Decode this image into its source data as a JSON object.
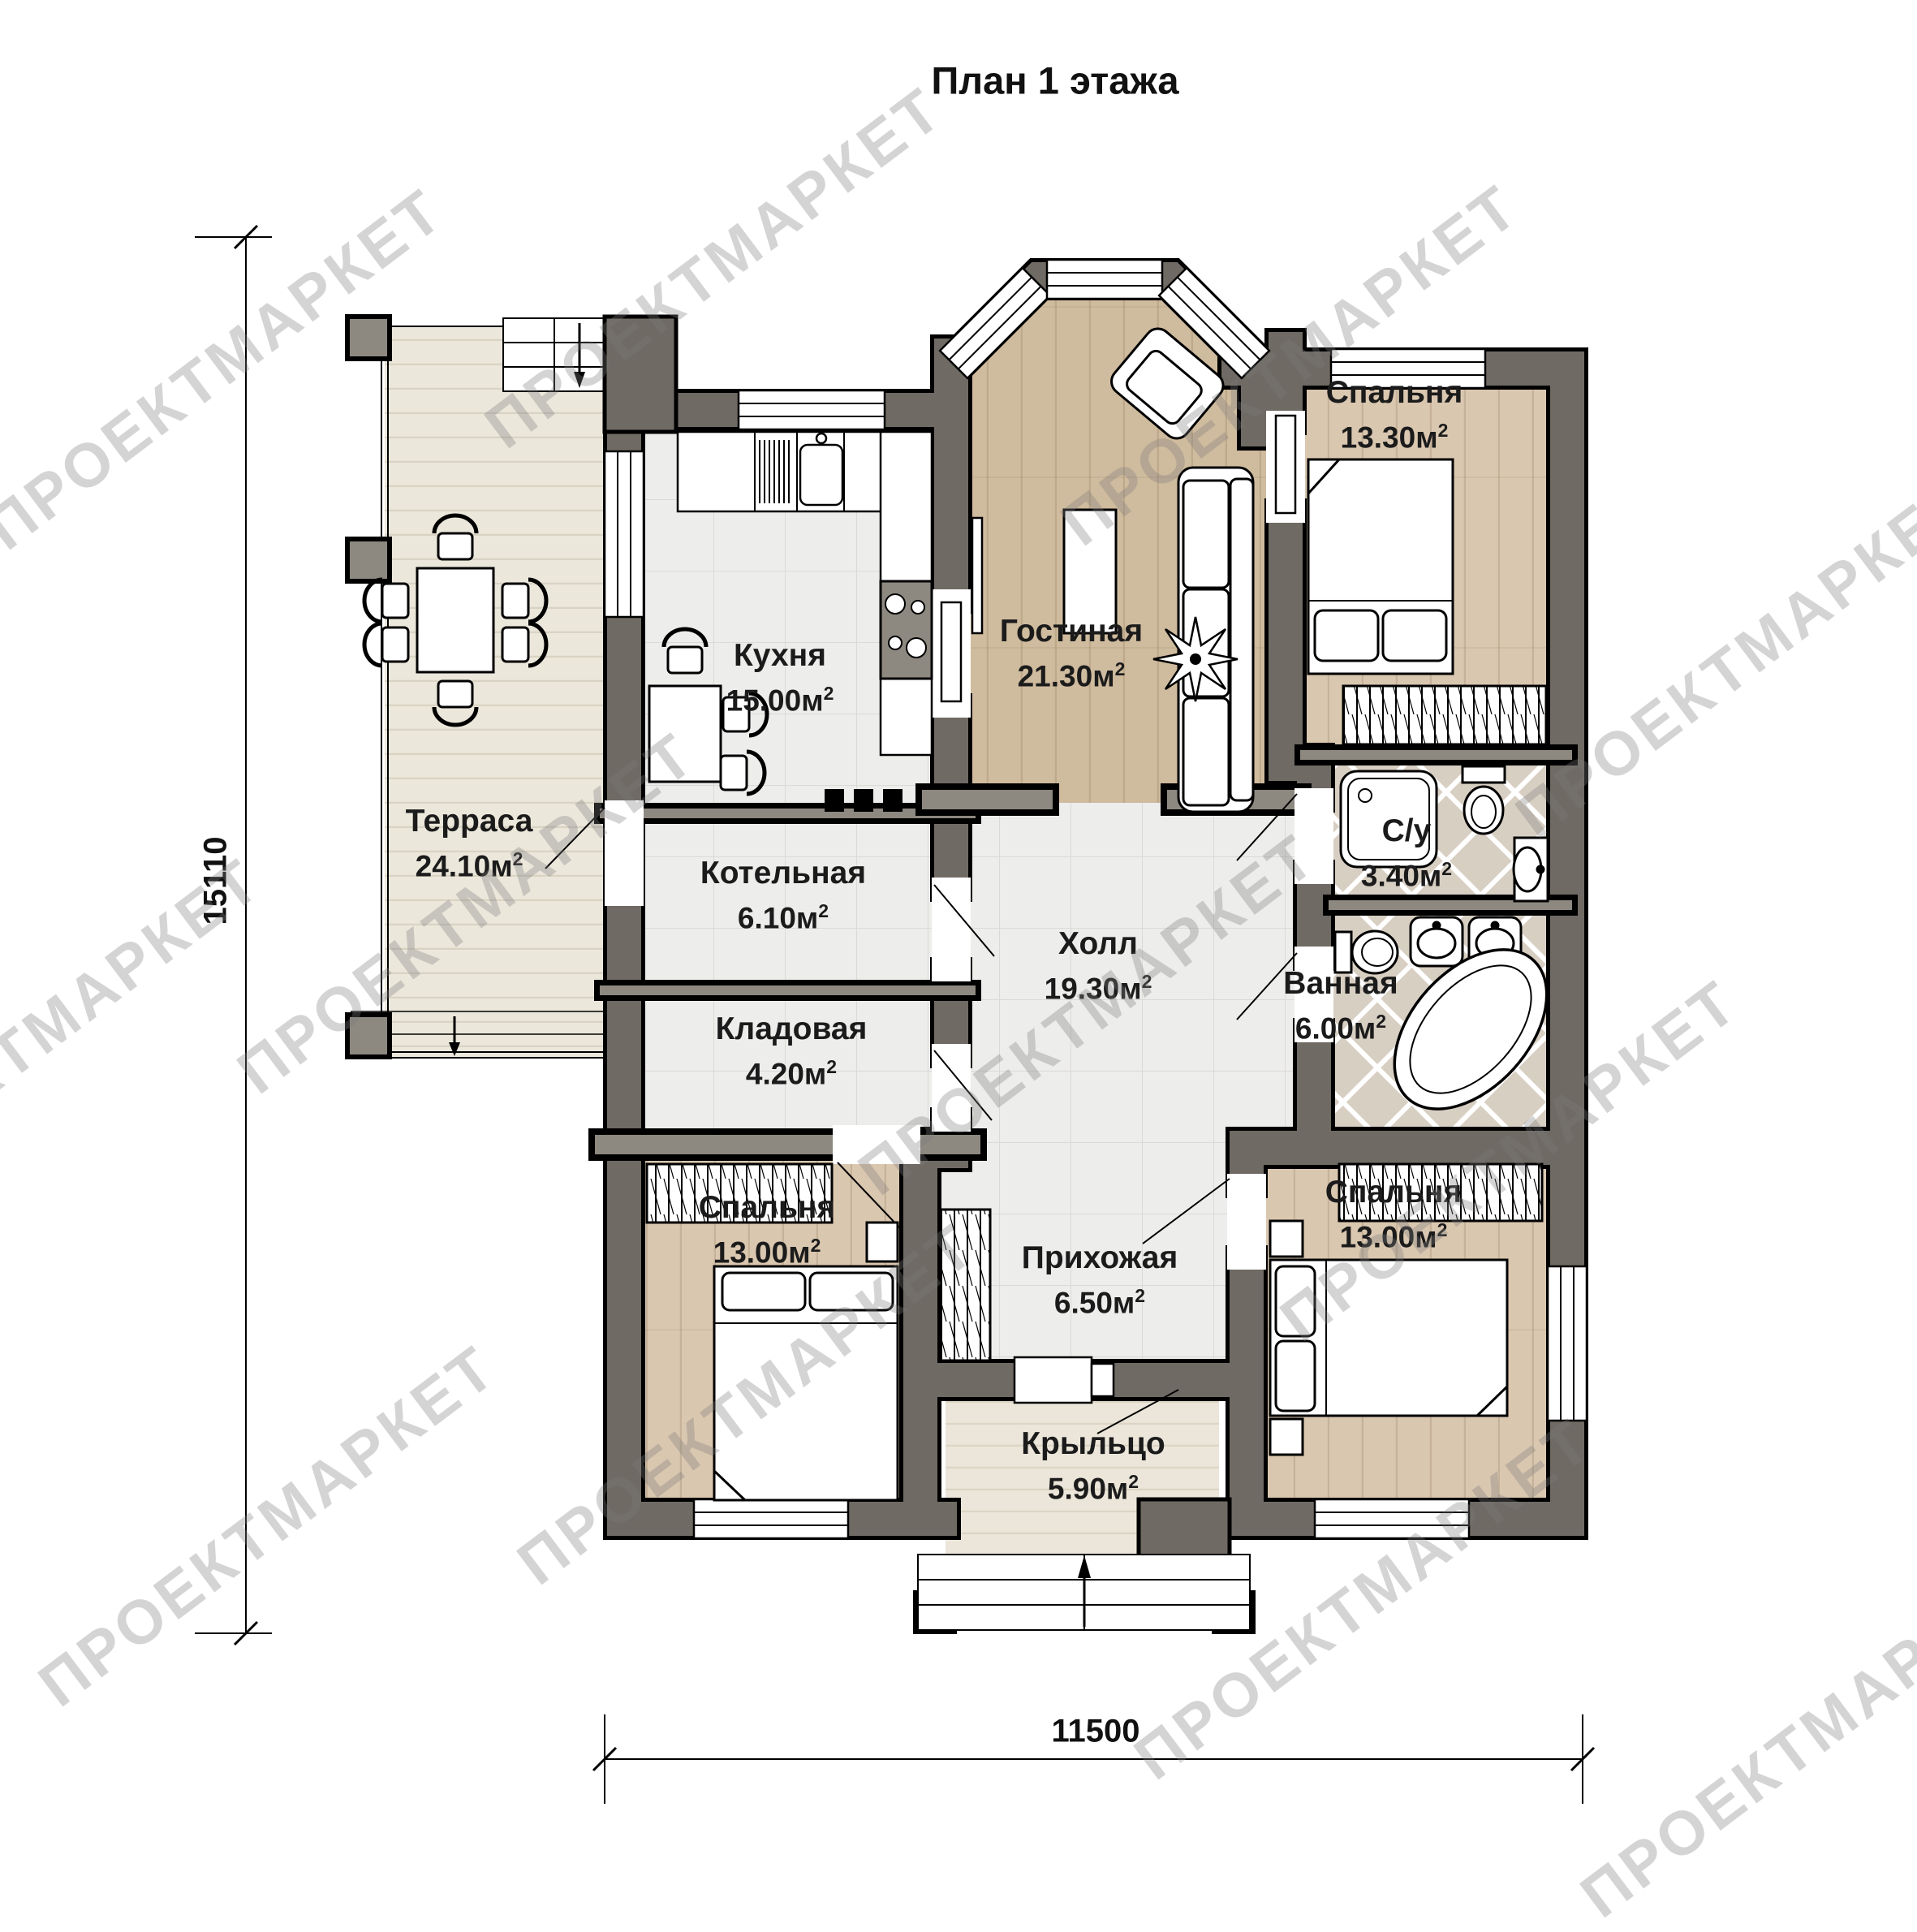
{
  "title": "План 1 этажа",
  "watermark_text": "ПРОЕКТМАРКЕТ",
  "area_exponent": "2",
  "dimensions": {
    "left": "15110",
    "bottom": "11500"
  },
  "rooms": {
    "terrace": {
      "name": "Терраса",
      "area": "24.10м"
    },
    "kitchen": {
      "name": "Кухня",
      "area": "15.00м"
    },
    "living": {
      "name": "Гостиная",
      "area": "21.30м"
    },
    "bedroom_top": {
      "name": "Спальня",
      "area": "13.30м"
    },
    "wc": {
      "name": "С/у",
      "area": "3.40м"
    },
    "bathroom": {
      "name": "Ванная",
      "area": "6.00м"
    },
    "boiler": {
      "name": "Котельная",
      "area": "6.10м"
    },
    "storage": {
      "name": "Кладовая",
      "area": "4.20м"
    },
    "hall": {
      "name": "Холл",
      "area": "19.30м"
    },
    "bedroom_left": {
      "name": "Спальня",
      "area": "13.00м"
    },
    "entry": {
      "name": "Прихожая",
      "area": "6.50м"
    },
    "bedroom_right": {
      "name": "Спальня",
      "area": "13.00м"
    },
    "porch": {
      "name": "Крыльцо",
      "area": "5.90м"
    }
  }
}
